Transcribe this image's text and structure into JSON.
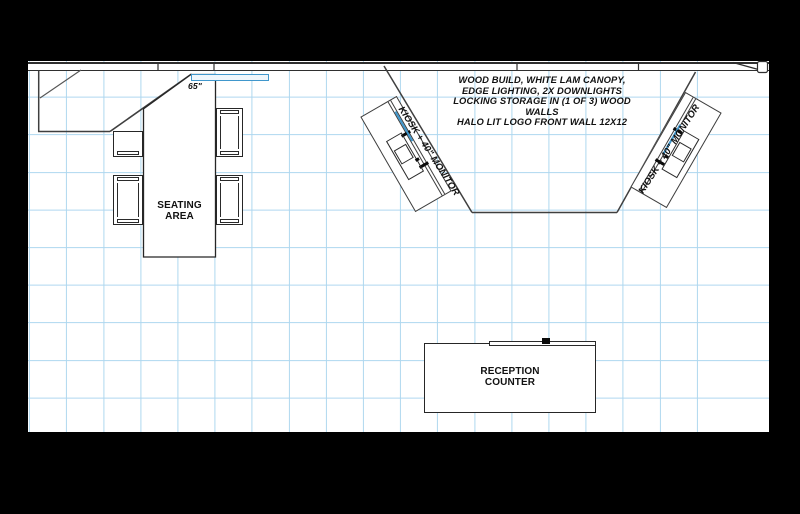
{
  "colors": {
    "background": "#000000",
    "paper": "#ffffff",
    "grid_line": "#aed7ef",
    "wall_line": "#3f3f3f",
    "highlight_blue": "#4097cc",
    "text": "#111111"
  },
  "annotations": {
    "note_lines": [
      "WOOD BUILD, WHITE LAM CANOPY,",
      "EDGE LIGHTING, 2X DOWNLIGHTS",
      "LOCKING STORAGE IN (1 OF 3) WOOD WALLS",
      "HALO LIT LOGO FRONT WALL 12X12"
    ],
    "monitor_size_label": "65\"",
    "kiosk_label": "KIOSK + 40\" MONITOR",
    "seating_area": {
      "line1": "SEATING",
      "line2": "AREA"
    },
    "reception_counter": {
      "line1": "RECEPTION",
      "line2": "COUNTER"
    }
  }
}
